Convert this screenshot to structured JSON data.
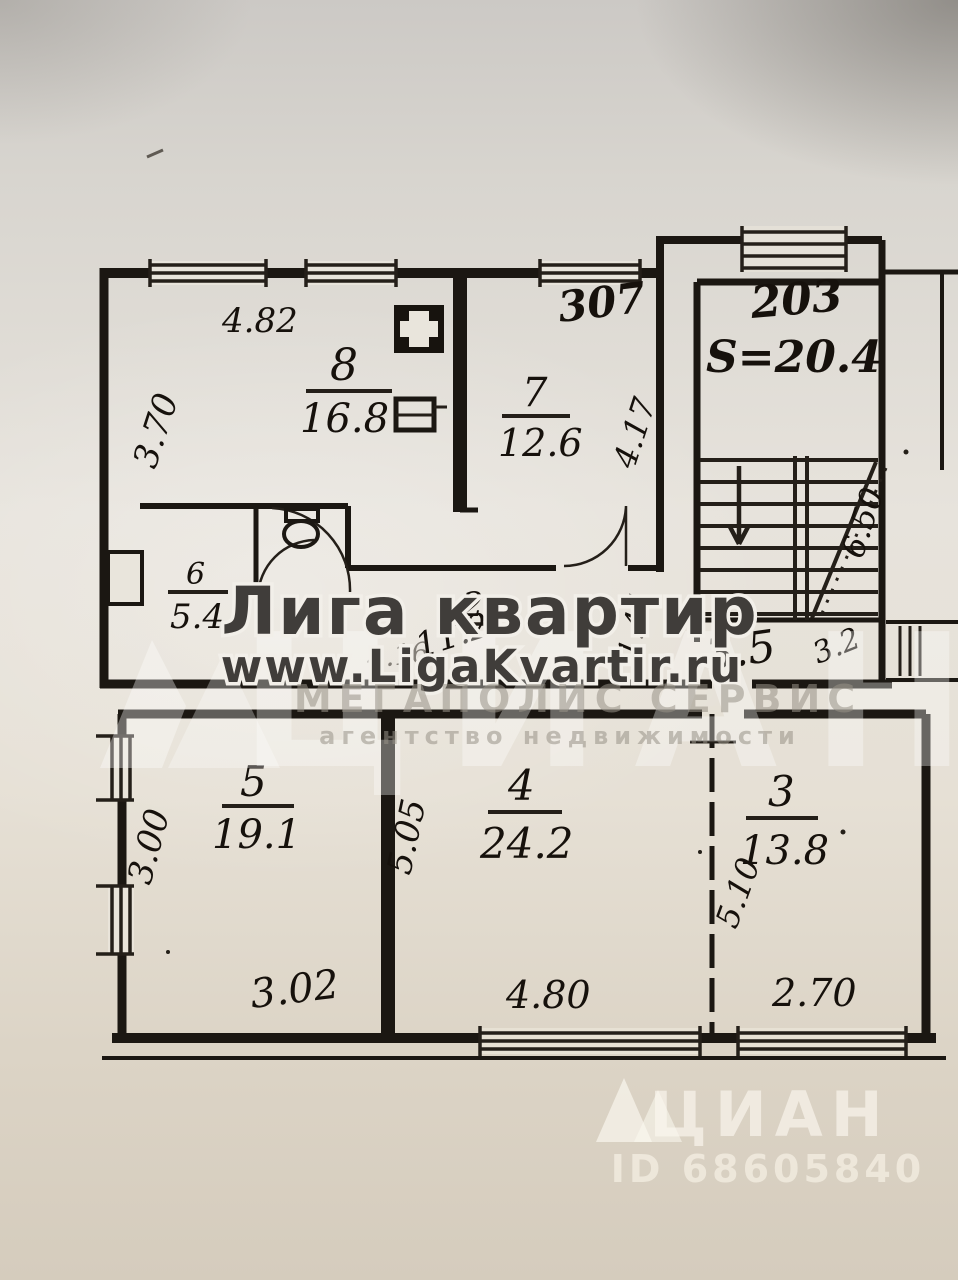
{
  "page": {
    "description": "Scanned photo of a BTI apartment floor plan with agency watermarks"
  },
  "plan": {
    "apartment_number_top": "307",
    "stairwell": {
      "unit_number": "203",
      "area_label": "S=20.4",
      "flight_dimension": "6.50"
    },
    "rooms": {
      "room8": {
        "number": "8",
        "area": "16.8"
      },
      "room7": {
        "number": "7",
        "area": "12.6"
      },
      "wc6": {
        "number": "6",
        "area": "5.4"
      },
      "corridor2": {
        "number": "2",
        "area": "11.2"
      },
      "room5": {
        "number": "5",
        "area": "19.1"
      },
      "room4": {
        "number": "4",
        "area": "24.2"
      },
      "room3": {
        "number": "3",
        "area": "13.8"
      }
    },
    "landing": {
      "area": "3.5",
      "dim": "3.2"
    },
    "dimensions": {
      "room8_width": "4.82",
      "room8_depth": "3.70",
      "room7_depth": "4.17",
      "corridor_length": "4.16",
      "corridor_width": "1.44",
      "room5_depth": "3.00",
      "room5_width": "3.02",
      "room45_wall": "5.05",
      "room4_width": "4.80",
      "room3_depth": "5.10",
      "room3_width": "2.70"
    }
  },
  "watermarks": {
    "brand": "Лига квартир",
    "site": "www.LigaKvartir.ru",
    "agency": "МЕГАПОЛИС СЕРВИС",
    "agency_sub": "агентство недвижимости",
    "portal": "ЦИАН",
    "listing_id": "ID 68605840"
  }
}
